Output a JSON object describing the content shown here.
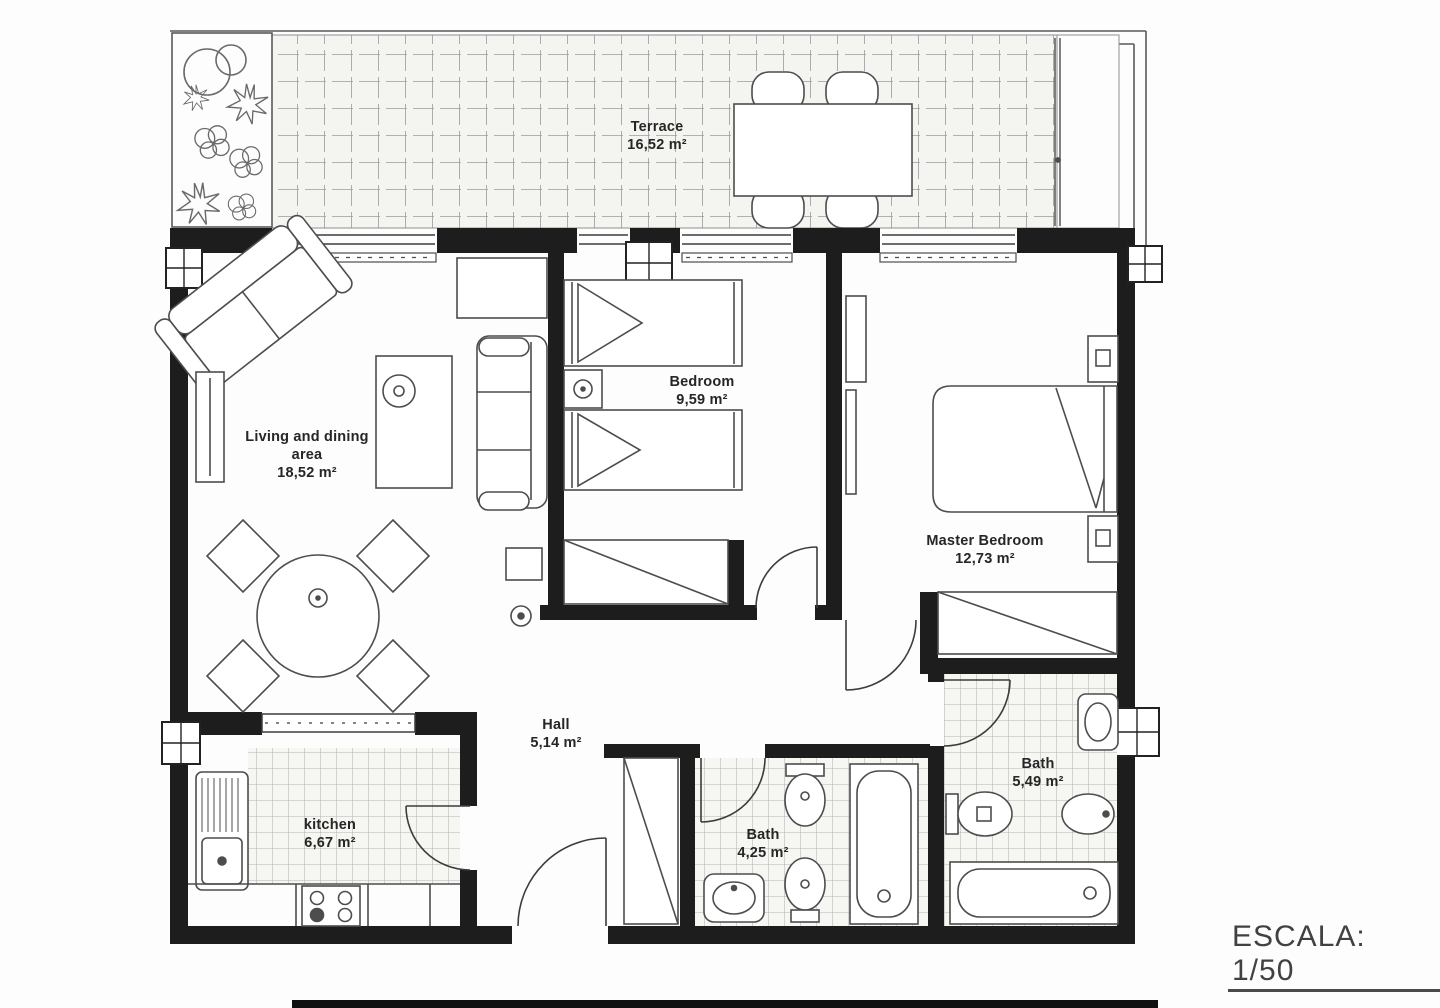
{
  "plan": {
    "rooms": {
      "terrace": {
        "name": "Terrace",
        "area": "16,52 m²"
      },
      "living": {
        "name": "Living and dining",
        "name2": "area",
        "area": "18,52 m²"
      },
      "bedroom": {
        "name": "Bedroom",
        "area": "9,59 m²"
      },
      "master": {
        "name": "Master Bedroom",
        "area": "12,73 m²"
      },
      "hall": {
        "name": "Hall",
        "area": "5,14 m²"
      },
      "kitchen": {
        "name": "kitchen",
        "area": "6,67 m²"
      },
      "bath_small": {
        "name": "Bath",
        "area": "4,25 m²"
      },
      "bath_big": {
        "name": "Bath",
        "area": "5,49 m²"
      }
    },
    "scale_label": "ESCALA: 1/50"
  }
}
